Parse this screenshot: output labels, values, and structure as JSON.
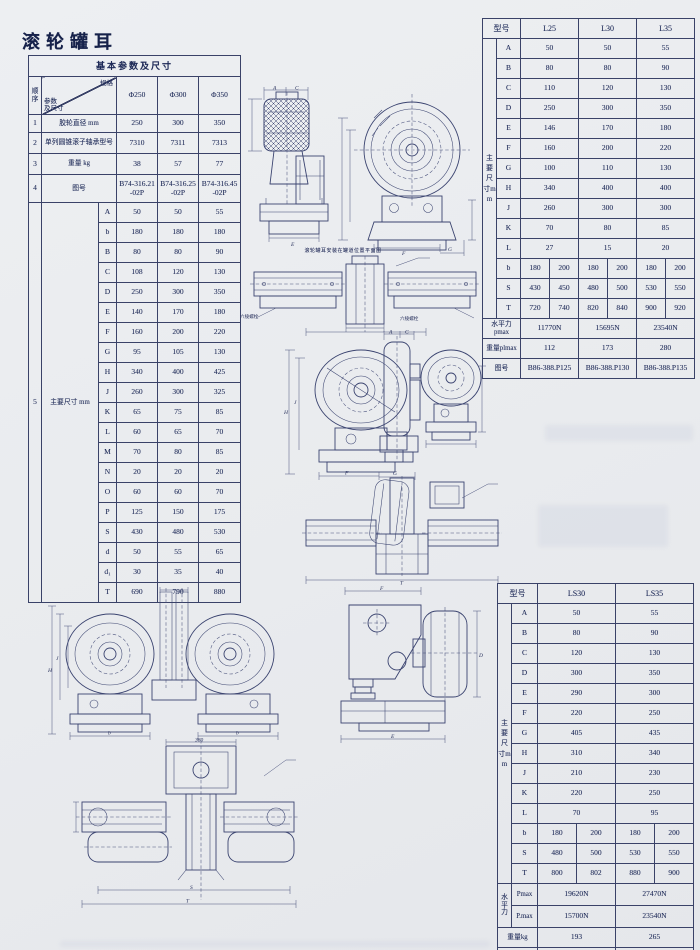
{
  "page": {
    "title": "滚轮罐耳"
  },
  "left_table": {
    "title": "基本参数及尺寸",
    "corner": {
      "seq": "顺序",
      "param": "参数\n及尺寸",
      "spec": "规格"
    },
    "spec_headers": [
      "Φ250",
      "Φ300",
      "Φ350"
    ],
    "rows": [
      {
        "seq": "1",
        "label": "胶轮直径 mm",
        "values": [
          "250",
          "300",
          "350"
        ]
      },
      {
        "seq": "2",
        "label": "单列圆锥滚子轴承型号",
        "values": [
          "7310",
          "7311",
          "7313"
        ]
      },
      {
        "seq": "3",
        "label": "重量 kg",
        "values": [
          "38",
          "57",
          "77"
        ]
      },
      {
        "seq": "4",
        "label": "图号",
        "values": [
          "B74-316.21\n-02P",
          "B74-316.25\n-02P",
          "B74-316.45\n-02P"
        ]
      }
    ],
    "dims_row": {
      "seq": "5",
      "label": "主要尺寸 mm",
      "dims": [
        {
          "letter": "A",
          "values": [
            "50",
            "50",
            "55"
          ]
        },
        {
          "letter": "b",
          "values": [
            "180",
            "180",
            "180"
          ]
        },
        {
          "letter": "B",
          "values": [
            "80",
            "80",
            "90"
          ]
        },
        {
          "letter": "C",
          "values": [
            "108",
            "120",
            "130"
          ]
        },
        {
          "letter": "D",
          "values": [
            "250",
            "300",
            "350"
          ]
        },
        {
          "letter": "E",
          "values": [
            "140",
            "170",
            "180"
          ]
        },
        {
          "letter": "F",
          "values": [
            "160",
            "200",
            "220"
          ]
        },
        {
          "letter": "G",
          "values": [
            "95",
            "105",
            "130"
          ]
        },
        {
          "letter": "H",
          "values": [
            "340",
            "400",
            "425"
          ]
        },
        {
          "letter": "J",
          "values": [
            "260",
            "300",
            "325"
          ]
        },
        {
          "letter": "K",
          "values": [
            "65",
            "75",
            "85"
          ]
        },
        {
          "letter": "L",
          "values": [
            "60",
            "65",
            "70"
          ]
        },
        {
          "letter": "M",
          "values": [
            "70",
            "80",
            "85"
          ]
        },
        {
          "letter": "N",
          "values": [
            "20",
            "20",
            "20"
          ]
        },
        {
          "letter": "O",
          "values": [
            "60",
            "60",
            "70"
          ]
        },
        {
          "letter": "P",
          "values": [
            "125",
            "150",
            "175"
          ]
        },
        {
          "letter": "S",
          "values": [
            "430",
            "480",
            "530"
          ]
        },
        {
          "letter": "d",
          "values": [
            "50",
            "55",
            "65"
          ]
        },
        {
          "letter": "d₁",
          "values": [
            "30",
            "35",
            "40"
          ]
        },
        {
          "letter": "T",
          "values": [
            "690",
            "790",
            "880"
          ]
        }
      ]
    }
  },
  "top_right_table": {
    "header_label": "型号",
    "models": [
      "L25",
      "L30",
      "L35"
    ],
    "side_label": "主要尺寸mm",
    "dims": [
      {
        "letter": "A",
        "values": [
          "50",
          "50",
          "55"
        ]
      },
      {
        "letter": "B",
        "values": [
          "80",
          "80",
          "90"
        ]
      },
      {
        "letter": "C",
        "values": [
          "110",
          "120",
          "130"
        ]
      },
      {
        "letter": "D",
        "values": [
          "250",
          "300",
          "350"
        ]
      },
      {
        "letter": "E",
        "values": [
          "146",
          "170",
          "180"
        ]
      },
      {
        "letter": "F",
        "values": [
          "160",
          "200",
          "220"
        ]
      },
      {
        "letter": "G",
        "values": [
          "100",
          "110",
          "130"
        ]
      },
      {
        "letter": "H",
        "values": [
          "340",
          "400",
          "400"
        ]
      },
      {
        "letter": "J",
        "values": [
          "260",
          "300",
          "300"
        ]
      },
      {
        "letter": "K",
        "values": [
          "70",
          "80",
          "85"
        ]
      },
      {
        "letter": "L",
        "values": [
          "27",
          "15",
          "20"
        ]
      },
      {
        "letter": "b",
        "split": [
          [
            "180",
            "200"
          ],
          [
            "180",
            "200"
          ],
          [
            "180",
            "200"
          ]
        ]
      },
      {
        "letter": "S",
        "split": [
          [
            "430",
            "450"
          ],
          [
            "480",
            "500"
          ],
          [
            "530",
            "550"
          ]
        ]
      },
      {
        "letter": "T",
        "split": [
          [
            "720",
            "740"
          ],
          [
            "820",
            "840"
          ],
          [
            "900",
            "920"
          ]
        ]
      }
    ],
    "footer_rows": [
      {
        "label": "水平力pmax",
        "values": [
          "11770N",
          "15695N",
          "23540N"
        ]
      },
      {
        "label": "重量plmax",
        "values": [
          "112",
          "173",
          "280"
        ]
      },
      {
        "label": "图号",
        "values": [
          "B86-388.P125",
          "B86-388.P130",
          "B86-388.P135"
        ]
      }
    ]
  },
  "bottom_right_table": {
    "header_label": "型号",
    "models": [
      "LS30",
      "LS35"
    ],
    "side_label": "主要尺寸mm",
    "dims": [
      {
        "letter": "A",
        "values": [
          "50",
          "55"
        ]
      },
      {
        "letter": "B",
        "values": [
          "80",
          "90"
        ]
      },
      {
        "letter": "C",
        "values": [
          "120",
          "130"
        ]
      },
      {
        "letter": "D",
        "values": [
          "300",
          "350"
        ]
      },
      {
        "letter": "E",
        "values": [
          "290",
          "300"
        ]
      },
      {
        "letter": "F",
        "values": [
          "220",
          "250"
        ]
      },
      {
        "letter": "G",
        "values": [
          "405",
          "435"
        ]
      },
      {
        "letter": "H",
        "values": [
          "310",
          "340"
        ]
      },
      {
        "letter": "J",
        "values": [
          "210",
          "230"
        ]
      },
      {
        "letter": "K",
        "values": [
          "220",
          "250"
        ]
      },
      {
        "letter": "L",
        "values": [
          "70",
          "95"
        ]
      },
      {
        "letter": "b",
        "split": [
          [
            "180",
            "200"
          ],
          [
            "180",
            "200"
          ]
        ]
      },
      {
        "letter": "S",
        "split": [
          [
            "480",
            "500"
          ],
          [
            "530",
            "550"
          ]
        ]
      },
      {
        "letter": "T",
        "split": [
          [
            "800",
            "802"
          ],
          [
            "880",
            "900"
          ]
        ]
      }
    ],
    "force_label": "水平力",
    "force_rows": [
      {
        "label": "Pmax",
        "values": [
          "19620N",
          "27470N"
        ]
      },
      {
        "label": "P.max",
        "values": [
          "15700N",
          "23540N"
        ]
      }
    ],
    "footer_rows": [
      {
        "label": "重量kg",
        "values": [
          "193",
          "265"
        ]
      },
      {
        "label": "图号",
        "values": [
          "B86-388.P230",
          "B86-388.P235"
        ]
      }
    ]
  },
  "drawings": {
    "caption_plan": "滚轮罐耳安装在罐道位置平面图",
    "bolt_label_left": "六棱螺栓",
    "bolt_label_right": "六棱螺栓",
    "letters": {
      "A": "A",
      "B": "B",
      "C": "C",
      "D": "D",
      "E": "E",
      "F": "F",
      "G": "G",
      "H": "H",
      "J": "J",
      "K": "K",
      "S": "S",
      "T": "T",
      "b": "b",
      "n380": "380"
    }
  }
}
